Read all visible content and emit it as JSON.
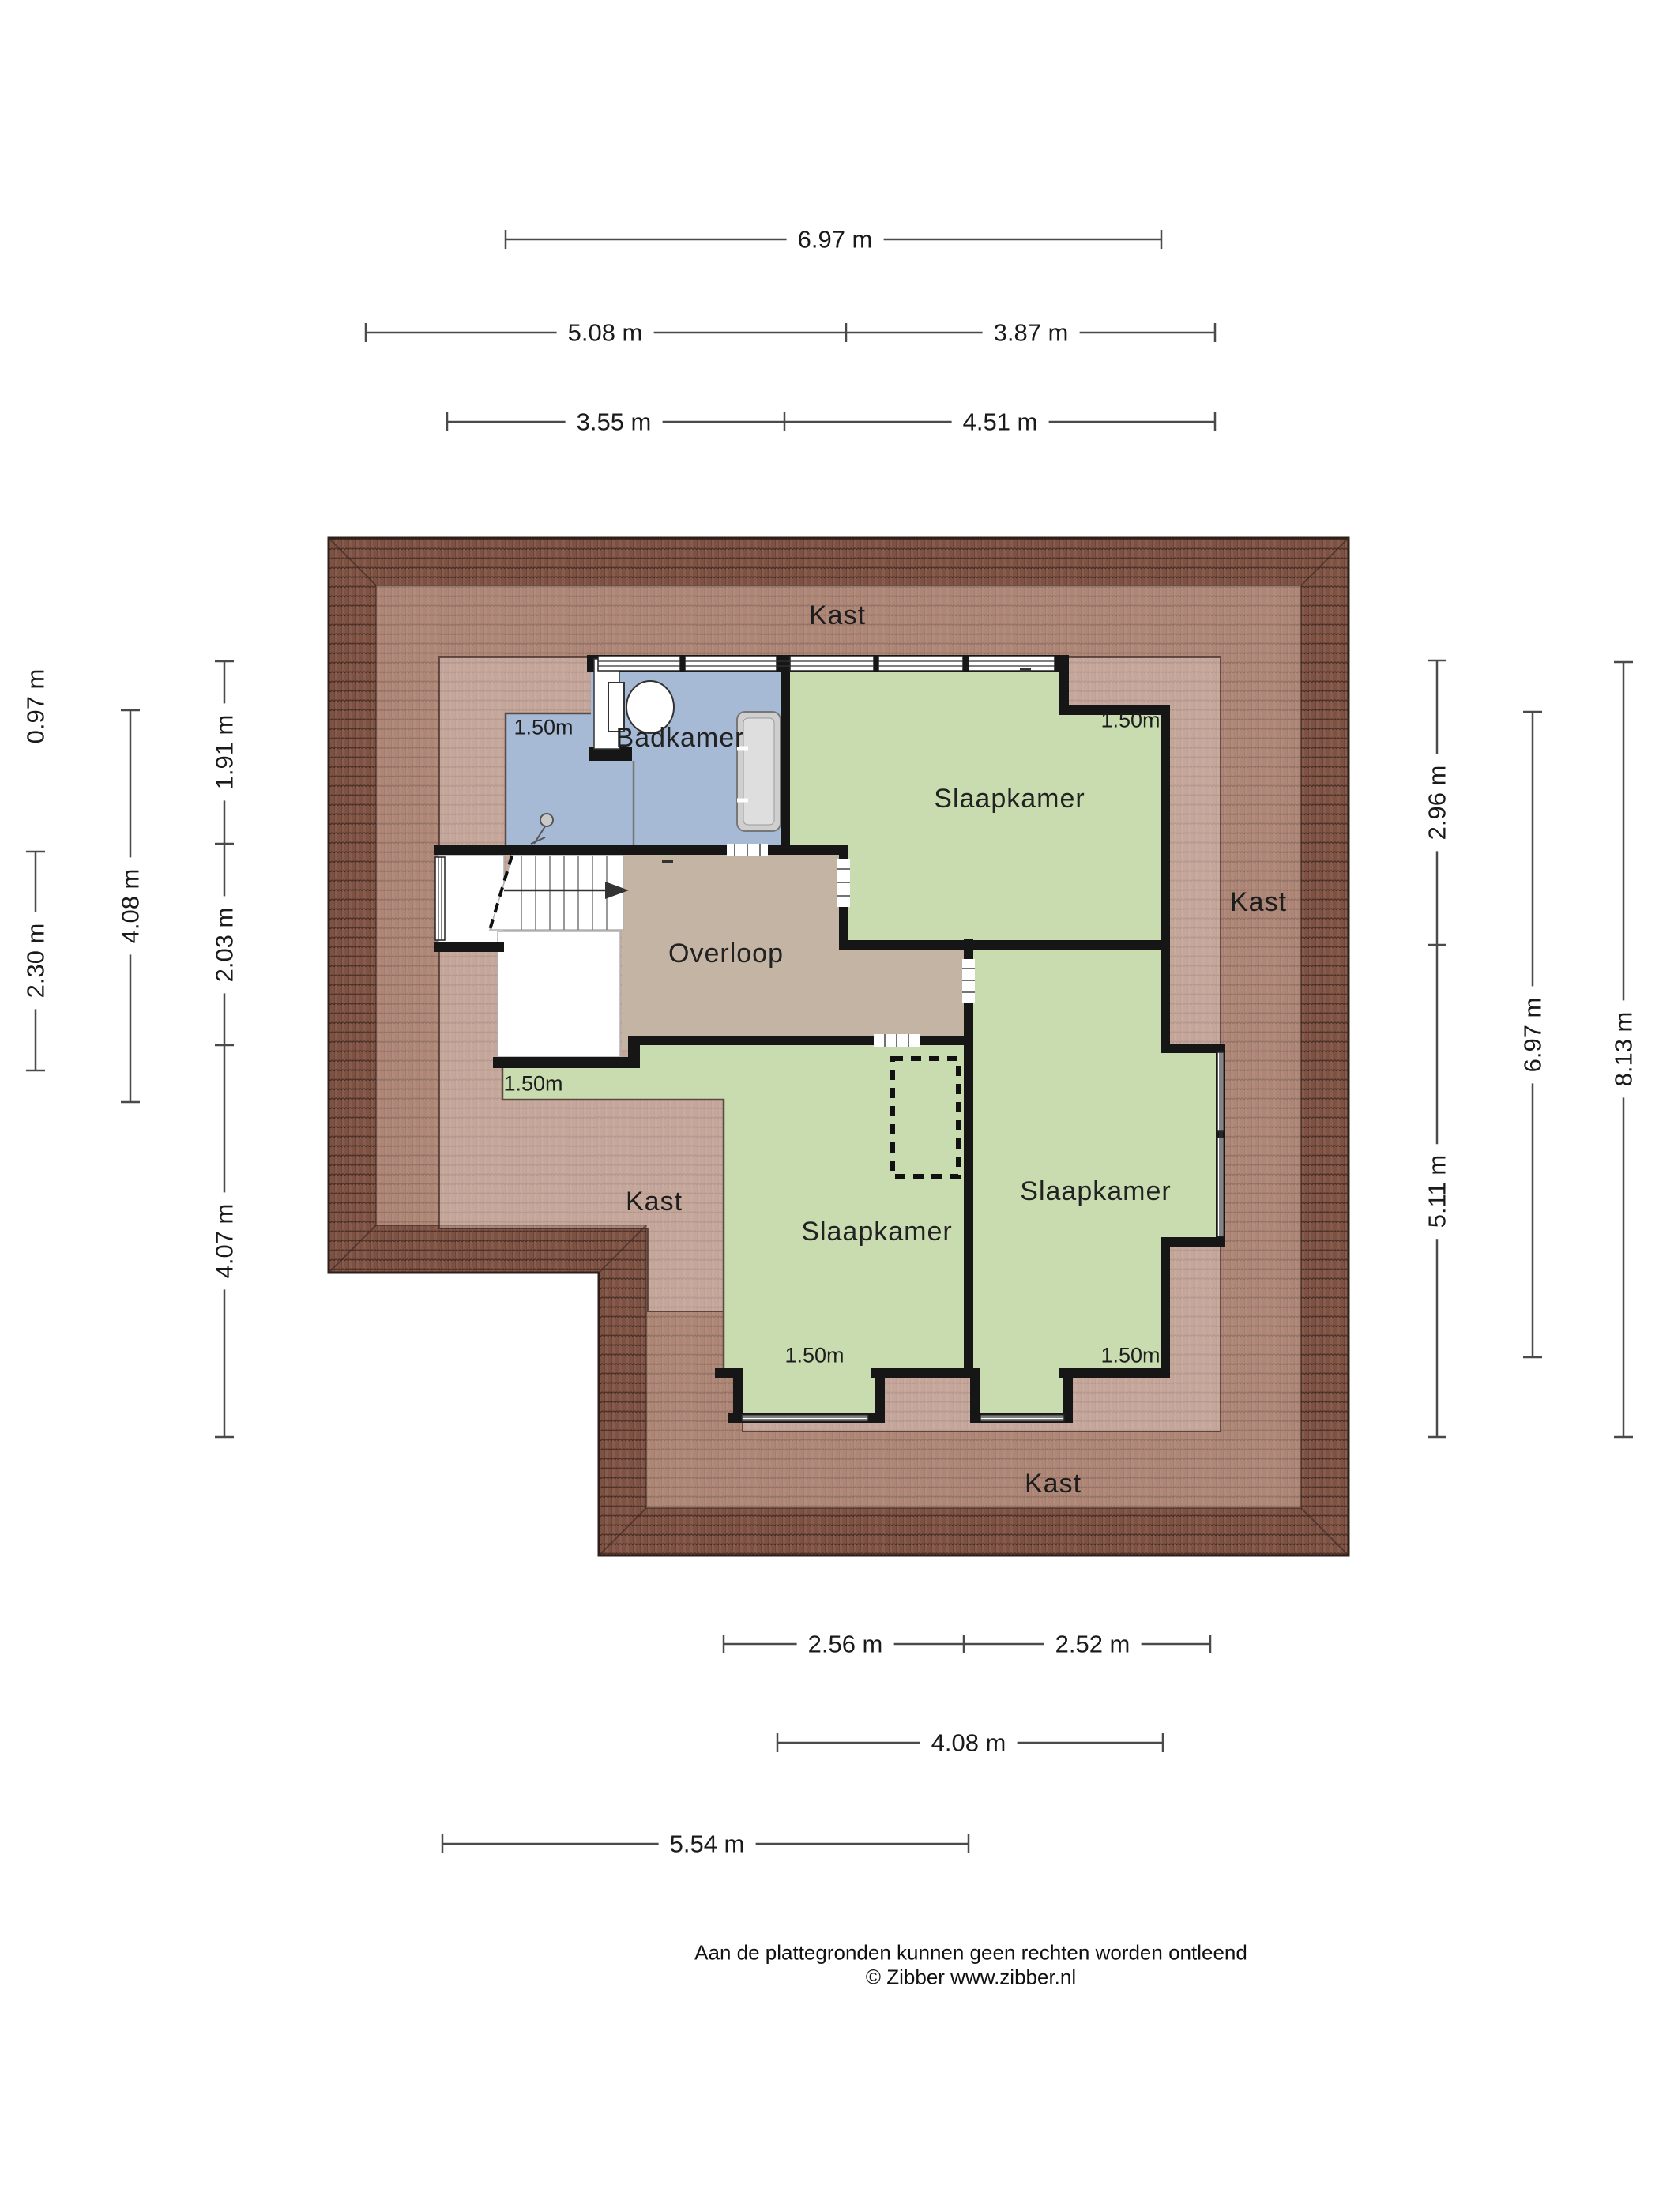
{
  "rooms": {
    "badkamer": "Badkamer",
    "slaapkamer_top_right": "Slaapkamer",
    "overloop": "Overloop",
    "slaapkamer_bottom_middle": "Slaapkamer",
    "slaapkamer_bottom_right": "Slaapkamer"
  },
  "closets": {
    "top": "Kast",
    "right": "Kast",
    "bottom_left": "Kast",
    "bottom": "Kast"
  },
  "knee_heights": {
    "badkamer": "1.50m",
    "top_right": "1.50m",
    "middle_left": "1.50m",
    "bottom_middle": "1.50m",
    "bottom_right": "1.50m"
  },
  "dimensions": {
    "top": [
      {
        "label": "6.97 m"
      },
      {
        "label": "5.08 m"
      },
      {
        "label": "3.87 m"
      },
      {
        "label": "3.55 m"
      },
      {
        "label": "4.51 m"
      }
    ],
    "bottom": [
      {
        "label": "2.56 m"
      },
      {
        "label": "2.52 m"
      },
      {
        "label": "4.08 m"
      },
      {
        "label": "5.54 m"
      }
    ],
    "left": [
      {
        "label": "0.97 m"
      },
      {
        "label": "2.30 m"
      },
      {
        "label": "4.08 m"
      },
      {
        "label": "1.91 m"
      },
      {
        "label": "2.03 m"
      },
      {
        "label": "4.07 m"
      }
    ],
    "right": [
      {
        "label": "2.96 m"
      },
      {
        "label": "5.11 m"
      },
      {
        "label": "6.97 m"
      },
      {
        "label": "8.13 m"
      }
    ]
  },
  "footer": {
    "line1": "Aan de plattegronden kunnen geen rechten worden ontleend",
    "line2": "© Zibber www.zibber.nl"
  },
  "colors": {
    "roof_base": "#7d5243",
    "roof_line": "#32201a",
    "room_green": "#c9dcb0",
    "room_blue": "#a6bad6",
    "room_tan": "#c4b4a4",
    "wall": "#161616"
  }
}
